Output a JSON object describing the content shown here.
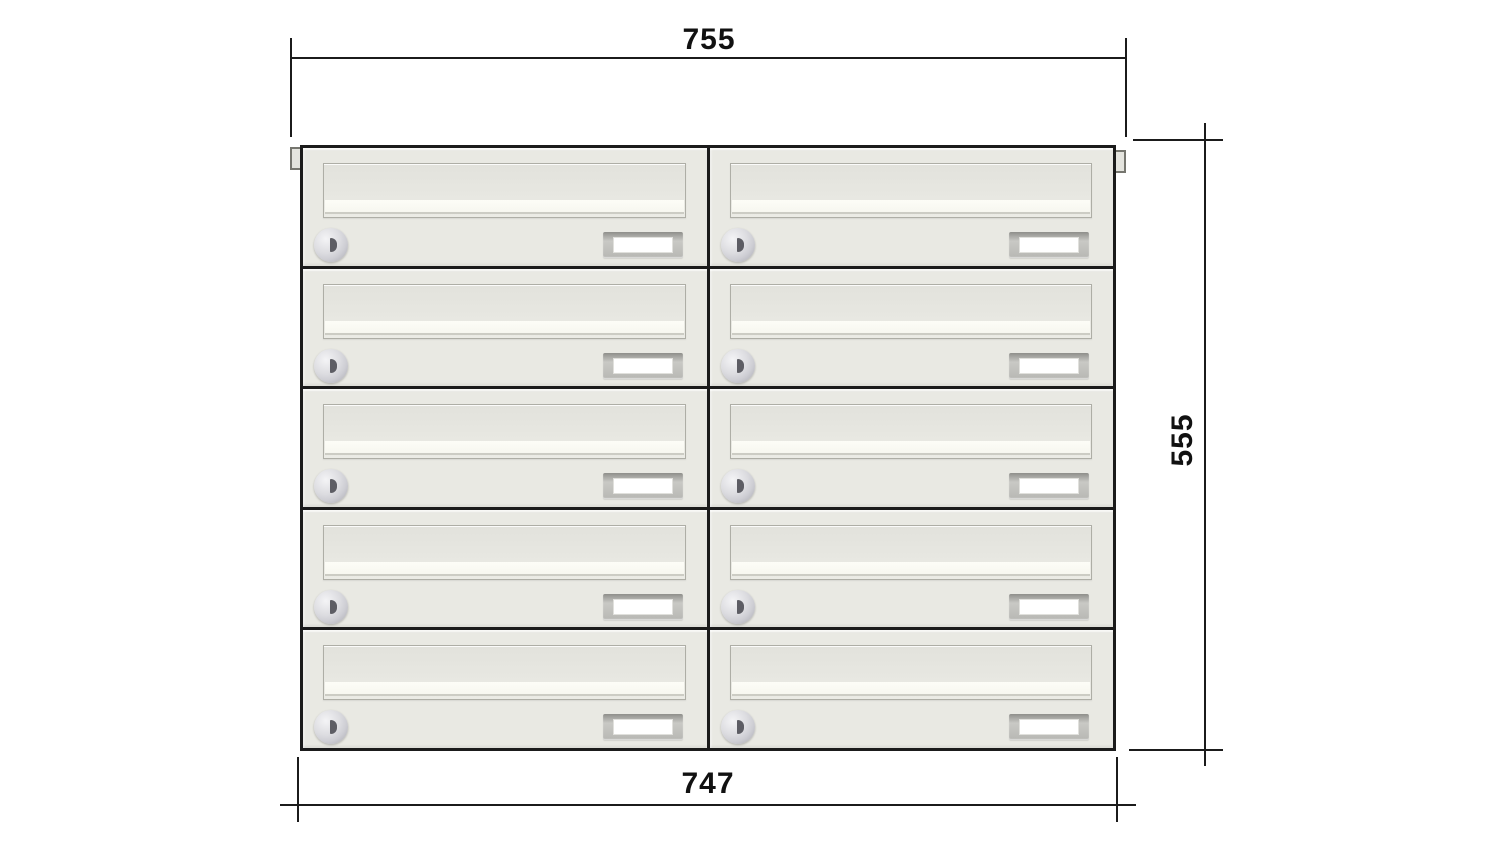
{
  "drawing": {
    "title": "mailbox-bank-front-elevation",
    "grid": {
      "rows": 5,
      "cols": 2,
      "units": 10
    },
    "dimensions": {
      "top_width": "755",
      "right_height": "555",
      "bottom_width": "747"
    },
    "colors": {
      "background": "#ffffff",
      "line": "#1b1b1b",
      "cabinet_fill": "#e9e9e3",
      "flap_border": "#aeaea6",
      "flap_face": "#e6e6e0",
      "flap_highlight": "#fdfdf7",
      "lock_silver": "#cdcdd3",
      "keyhole": "#5d5d64",
      "nameplate_frame": "#b7b7b3",
      "nameplate_window": "#ffffff"
    }
  }
}
